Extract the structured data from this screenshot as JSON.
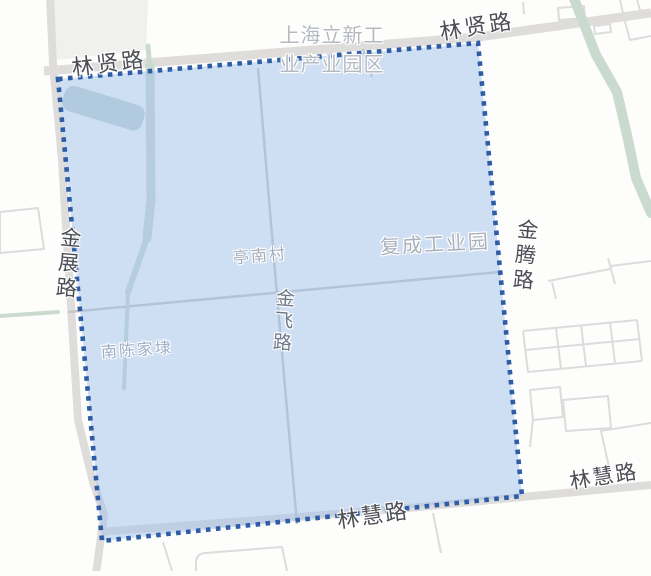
{
  "map": {
    "type": "map-area-selection",
    "labels": {
      "linxian_left": "林贤路",
      "linxian_right": "林贤路",
      "lixin_park_line1": "上海立新工",
      "lixin_park_line2": "业产业园区",
      "jinzhan": "金展路",
      "jinteng": "金腾路",
      "jinfei": "金飞路",
      "tingnan": "亭南村",
      "fucheng": "复成工业园",
      "nanchen": "南陈家埭",
      "linhui_center": "林慧路",
      "linhui_right": "林慧路"
    },
    "colors": {
      "selection_fill": "#cfdff4",
      "selection_border": "#2e5da6",
      "road": "#dedddb",
      "minor_outline": "#dcdcdc",
      "water": "#cbdacf",
      "road_label": "#4b4e54",
      "area_label": "#a8b0bc",
      "background": "#fdfdfc"
    }
  }
}
